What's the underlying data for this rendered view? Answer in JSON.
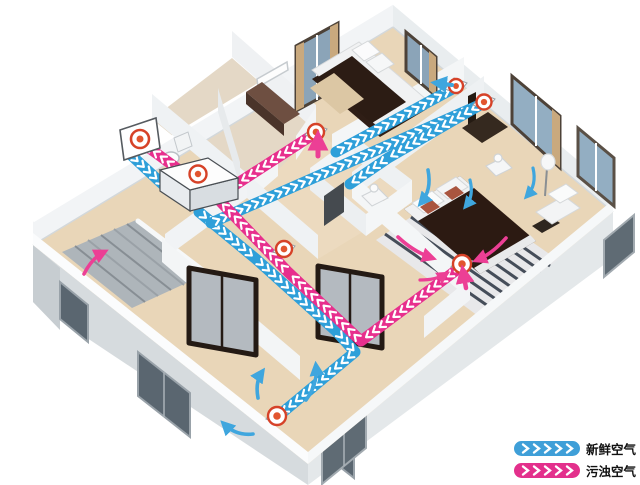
{
  "legend": {
    "items": [
      {
        "id": "fresh",
        "label": "新鲜空气",
        "color": "#3f9fd8"
      },
      {
        "id": "exhaust",
        "label": "污浊空气",
        "color": "#e3308c"
      }
    ]
  },
  "diagram": {
    "colors": {
      "fresh": "#2e9fd9",
      "exhaust": "#e72f8d",
      "chevron": "#ffffff",
      "diffuser_red": "#d64228",
      "diffuser_dot": "#e2552f"
    },
    "ducts": [
      {
        "name": "fresh-intake-duct",
        "type": "fresh",
        "points": [
          [
            131,
            155
          ],
          [
            172,
            193
          ]
        ]
      },
      {
        "name": "fresh-supply-living-duct",
        "type": "fresh",
        "points": [
          [
            199,
            212
          ],
          [
            256,
            259
          ],
          [
            336,
            331
          ],
          [
            355,
            352
          ],
          [
            277,
            417
          ]
        ]
      },
      {
        "name": "fresh-supply-main-duct",
        "type": "fresh",
        "points": [
          [
            211,
            223
          ],
          [
            484,
            103
          ]
        ]
      },
      {
        "name": "fresh-supply-bedroom1-duct",
        "type": "fresh",
        "points": [
          [
            336,
            152
          ],
          [
            456,
            87
          ]
        ]
      },
      {
        "name": "fresh-supply-master-duct",
        "type": "fresh",
        "points": [
          [
            480,
            105
          ],
          [
            388,
            158
          ],
          [
            350,
            184
          ]
        ]
      },
      {
        "name": "exhaust-master-duct",
        "type": "exhaust",
        "points": [
          [
            462,
            266
          ],
          [
            361,
            341
          ],
          [
            288,
            272
          ],
          [
            216,
            197
          ],
          [
            141,
            142
          ]
        ]
      },
      {
        "name": "exhaust-bedroom1-duct",
        "type": "exhaust",
        "points": [
          [
            314,
            134
          ],
          [
            218,
            196
          ]
        ]
      }
    ],
    "diffusers": [
      {
        "name": "outdoor-vent-hood",
        "type": "panel",
        "x": 140,
        "y": 139
      },
      {
        "name": "hrv-unit",
        "type": "unit",
        "x": 197,
        "y": 176
      },
      {
        "name": "supply-diffuser-bedroom1",
        "type": "round",
        "x": 456,
        "y": 86,
        "r": 7
      },
      {
        "name": "supply-diffuser-master",
        "type": "round",
        "x": 484,
        "y": 102,
        "r": 7.5
      },
      {
        "name": "return-grille-bedroom1",
        "type": "round",
        "x": 316,
        "y": 132,
        "r": 8
      },
      {
        "name": "return-grille-hall",
        "type": "round",
        "x": 284,
        "y": 249,
        "r": 8
      },
      {
        "name": "return-grille-master",
        "type": "round",
        "x": 462,
        "y": 264,
        "r": 9
      },
      {
        "name": "supply-grille-living",
        "type": "round",
        "x": 277,
        "y": 416,
        "r": 9
      }
    ],
    "flow_arrows": [
      {
        "name": "living-air-arrow-1",
        "type": "fresh",
        "path": "M258,398 Q255,382 262,372",
        "w": 3.6
      },
      {
        "name": "living-air-arrow-2",
        "type": "fresh",
        "path": "M306,400 Q318,384 316,366",
        "w": 3.6
      },
      {
        "name": "living-air-arrow-3",
        "type": "fresh",
        "path": "M253,434 Q236,436 224,424",
        "w": 3.6
      },
      {
        "name": "master-air-arrow-1",
        "type": "fresh",
        "path": "M428,170 Q432,190 421,203",
        "w": 3.6
      },
      {
        "name": "master-air-arrow-2",
        "type": "fresh",
        "path": "M470,180 Q474,196 466,206",
        "w": 3.2
      },
      {
        "name": "master-air-arrow-3",
        "type": "fresh",
        "path": "M533,168 Q537,185 527,196",
        "w": 3.2
      },
      {
        "name": "bedroom1-supply-arrow",
        "type": "fresh",
        "path": "M452,85 L436,83",
        "w": 4
      },
      {
        "name": "bedroom1-return-arrow",
        "type": "exhaust",
        "path": "M318,156 L318,137",
        "w": 5
      },
      {
        "name": "master-return-arrow",
        "type": "exhaust",
        "path": "M466,288 L463,271",
        "w": 4.5
      },
      {
        "name": "master-exhaust-arrow-1",
        "type": "exhaust",
        "path": "M398,237 Q414,252 432,258",
        "w": 3.6
      },
      {
        "name": "master-exhaust-arrow-2",
        "type": "exhaust",
        "path": "M506,238 Q492,254 477,260",
        "w": 3.6
      },
      {
        "name": "master-exhaust-arrow-3",
        "type": "exhaust",
        "path": "M420,280 Q436,280 446,274",
        "w": 3.2
      },
      {
        "name": "stairs-exhaust-arrow",
        "type": "exhaust",
        "path": "M84,274 Q92,258 104,252",
        "w": 3.6
      }
    ]
  }
}
